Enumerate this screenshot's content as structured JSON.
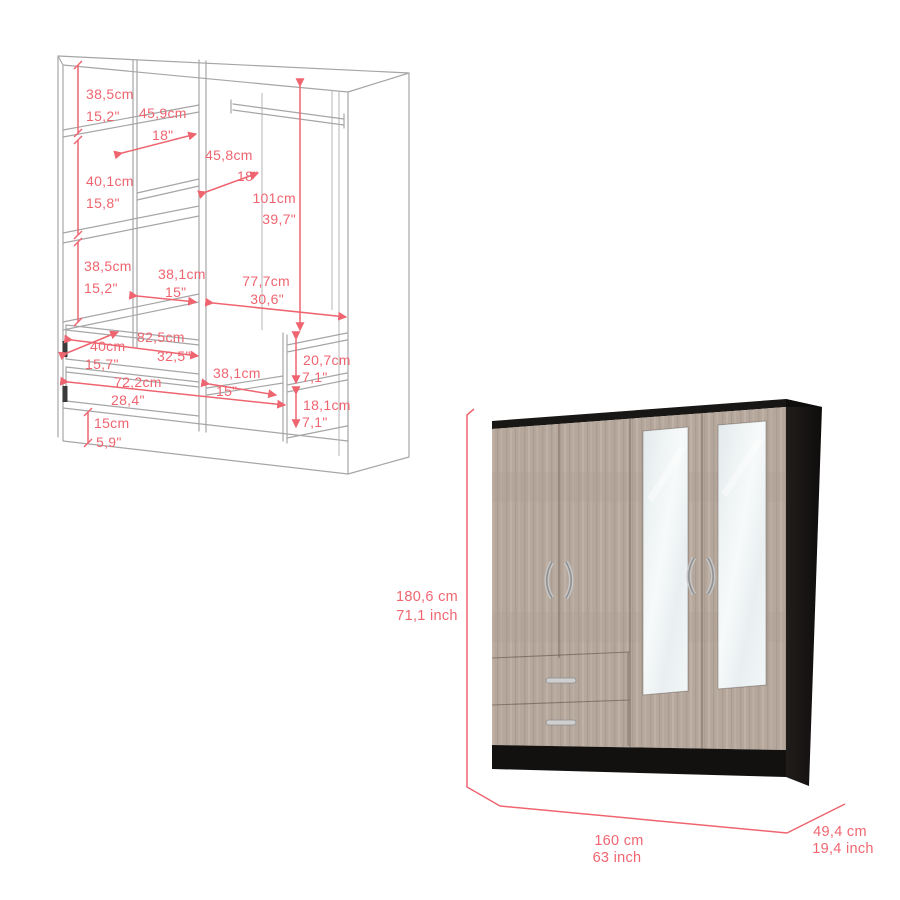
{
  "page": {
    "background": "#ffffff",
    "description_colors": {
      "dimension_red": "#ee6570",
      "wireframe_gray": "#a6a6a6",
      "wood": "#b5a79b",
      "dark_panel": "#171513",
      "mirror": "#eef2f3",
      "handle_silver": "#c6c6c6"
    }
  },
  "diagram": {
    "dims": [
      {
        "id": "upper-section-height",
        "cm": "38,5cm",
        "inch": "15,2\""
      },
      {
        "id": "top-shelf-depth",
        "cm": "45,9cm",
        "inch": "18\""
      },
      {
        "id": "middle-shelf-depth",
        "cm": "45,8cm",
        "inch": "18\""
      },
      {
        "id": "second-section-height",
        "cm": "40,1cm",
        "inch": "15,8\""
      },
      {
        "id": "hanging-area-height",
        "cm": "101cm",
        "inch": "39,7\""
      },
      {
        "id": "third-section-height",
        "cm": "38,5cm",
        "inch": "15,2\""
      },
      {
        "id": "shelf-width",
        "cm": "38,1cm",
        "inch": "15\""
      },
      {
        "id": "hanging-area-width",
        "cm": "77,7cm",
        "inch": "30,6\""
      },
      {
        "id": "top-drawer-width",
        "cm": "82,5cm",
        "inch": "32,5\""
      },
      {
        "id": "drawer-depth",
        "cm": "40cm",
        "inch": "15,7\""
      },
      {
        "id": "bottom-drawer-width",
        "cm": "72,2cm",
        "inch": "28,4\""
      },
      {
        "id": "lower-shelf-width",
        "cm": "38,1cm",
        "inch": "15\""
      },
      {
        "id": "upper-cubby-height",
        "cm": "20,7cm",
        "inch": "7,1\""
      },
      {
        "id": "lower-cubby-height",
        "cm": "18,1cm",
        "inch": "7,1\""
      },
      {
        "id": "base-height",
        "cm": "15cm",
        "inch": "5,9\""
      }
    ]
  },
  "render": {
    "dims": {
      "height": {
        "cm": "180,6 cm",
        "inch": "71,1 inch"
      },
      "width": {
        "cm": "160 cm",
        "inch": "63 inch"
      },
      "depth": {
        "cm": "49,4 cm",
        "inch": "19,4 inch"
      }
    }
  }
}
